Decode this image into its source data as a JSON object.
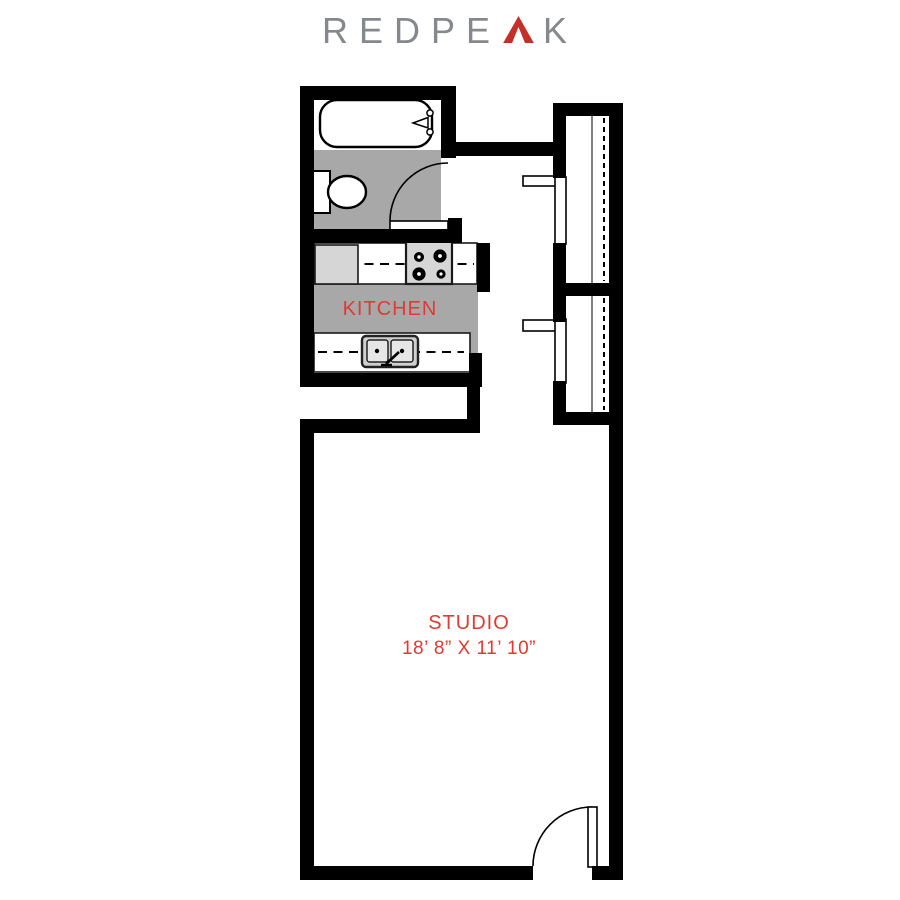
{
  "brand": {
    "name": "REDPEAK",
    "logo_prefix": "REDPE",
    "logo_suffix": "K",
    "logo_letter_color": "#85888d",
    "logo_peak_color": "#c62f28"
  },
  "floorplan": {
    "rooms": {
      "kitchen": {
        "label": "KITCHEN"
      },
      "studio": {
        "label": "STUDIO",
        "dimensions": "18’ 8” X 11’ 10”"
      }
    },
    "colors": {
      "wall": "#000000",
      "floor_gray": "#a8a8a8",
      "appliance_gray": "#d6d6d6",
      "label_red": "#e03a32"
    },
    "fixtures": [
      "bathtub",
      "toilet",
      "bathroom-door",
      "refrigerator",
      "stove",
      "double-sink",
      "closet-1",
      "closet-2",
      "closet-rods",
      "entry-door"
    ]
  }
}
